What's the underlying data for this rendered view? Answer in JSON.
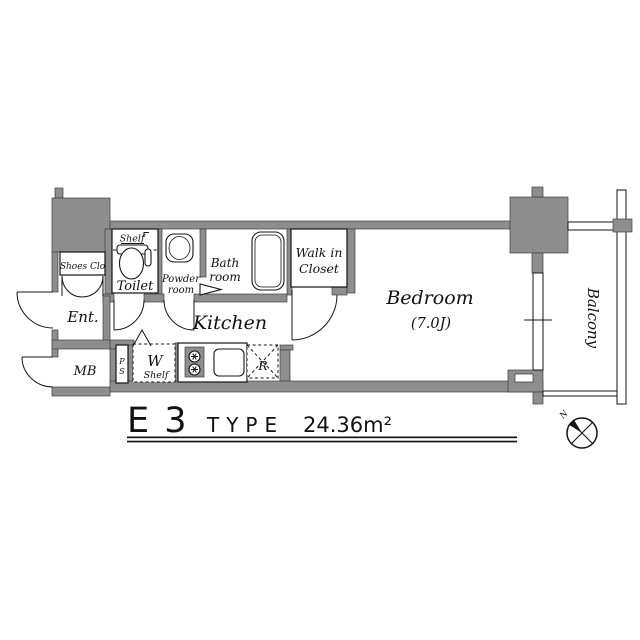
{
  "plan": {
    "title": {
      "code": "E 3",
      "type_label": "TYPE",
      "area": "24.36m²"
    },
    "rooms": {
      "shoes_closet": "Shoes Clo",
      "entrance": "Ent.",
      "meter_box": "MB",
      "toilet": "Toilet",
      "toilet_shelf": "Shelf",
      "powder_line1": "Powder",
      "powder_line2": "room",
      "bath_line1": "Bath",
      "bath_line2": "room",
      "wic_line1": "Walk in",
      "wic_line2": "Closet",
      "kitchen": "Kitchen",
      "bedroom": "Bedroom",
      "bedroom_size": "(7.0J)",
      "balcony": "Balcony",
      "pipe_space_p": "P",
      "pipe_space_s": "S",
      "washer": "W",
      "washer_shelf": "Shelf",
      "refrigerator": "R"
    },
    "compass_north": "N",
    "colors": {
      "wall": "#8e8e8e",
      "line": "#141414",
      "background": "#ffffff"
    }
  }
}
